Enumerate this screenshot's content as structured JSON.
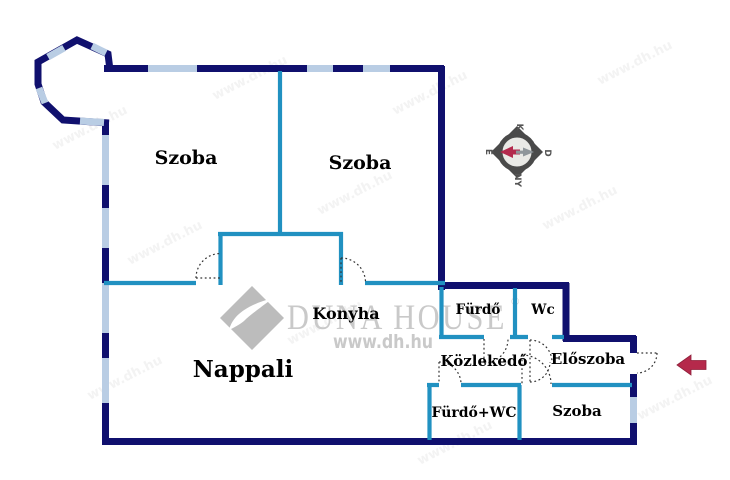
{
  "rooms": {
    "szoba1": "Szoba",
    "szoba2": "Szoba",
    "nappali": "Nappali",
    "konyha": "Konyha",
    "furdo": "Fürdő",
    "wc": "Wc",
    "kozlekedo": "Közlekedő",
    "eloszoba": "Előszoba",
    "furdo_wc": "Fürdő+WC",
    "szoba3": "Szoba"
  },
  "watermark": {
    "brand": "DUNA HOUSE",
    "registered": "®",
    "url": "www.dh.hu",
    "tile": "www.dh.hu"
  },
  "compass": {
    "top": "K",
    "right": "D",
    "bottom": "NY",
    "left": "É"
  },
  "colors": {
    "outer_wall": "#10106e",
    "partition_wall": "#2191c1",
    "window": "#b9cde4",
    "door_dash": "#333333",
    "entry_arrow": "#b5294b",
    "compass_dark": "#4a4a4a",
    "compass_face": "#e9e9e6",
    "needle_north": "#b3294d",
    "needle_south": "#8f969b",
    "watermark_gray": "#c9c9c9",
    "label_black": "#000000"
  }
}
